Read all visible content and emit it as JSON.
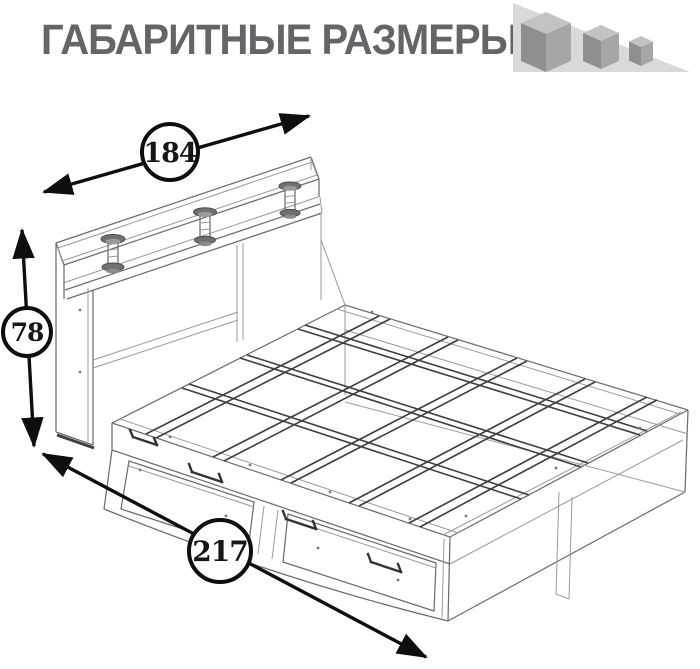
{
  "header": {
    "title": "ГАБАРИТНЫЕ РАЗМЕРЫ",
    "title_color": "#646568",
    "logo": {
      "icon": "three-cubes-logo",
      "triangle_color": "#d9d9db",
      "cube_top_color": "#c3c3c5",
      "cube_left_color": "#8f8f91",
      "cube_right_color": "#a6a6a8"
    }
  },
  "drawing": {
    "kind": "bed-overall-dimensions-wireframe",
    "line_color": "#6d6d6f",
    "slat_color": "#3e3e40",
    "dimension_color": "#0e0e0e",
    "dimensions": {
      "width": {
        "value": "184",
        "arrow": "diagonal-up-right"
      },
      "height": {
        "value": "78",
        "arrow": "vertical"
      },
      "length": {
        "value": "217",
        "arrow": "diagonal-down-right"
      }
    }
  }
}
